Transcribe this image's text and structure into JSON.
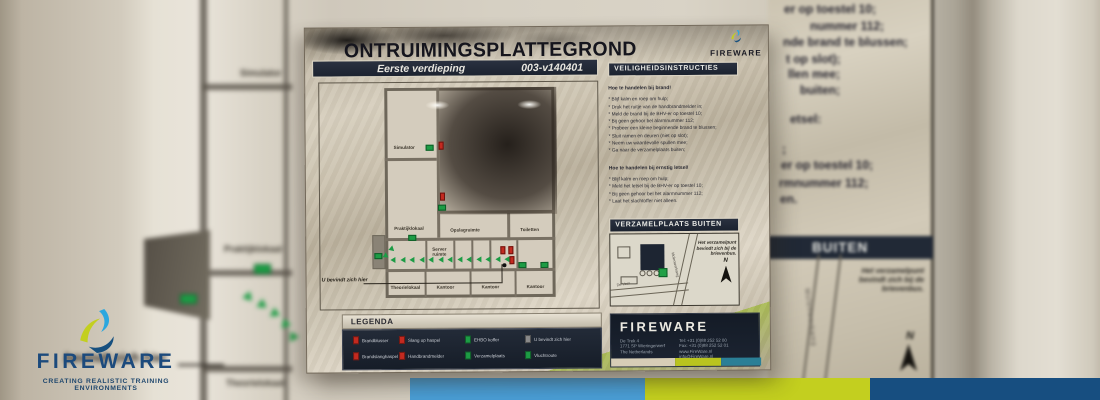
{
  "branding": {
    "wordmark": "FIREWARE",
    "tagline": "CREATING REALISTIC TRAINING ENVIRONMENTS",
    "colors": {
      "cyan": "#2ba7df",
      "lime": "#c3cf1f",
      "navy": "#17507f"
    }
  },
  "bottom_bars": {
    "blue": "#4a9ed6",
    "lime": "#c3cf1f",
    "navy": "#174e80"
  },
  "sign": {
    "title": "ONTRUIMINGSPLATTEGROND",
    "floor_label": "Eerste verdieping",
    "doc_number": "003-v140401",
    "brand": "FIREWARE",
    "you_are_here_label": "U bevindt zich hier",
    "floorplan": {
      "rooms": {
        "simulator": "Simulator",
        "praktijklokaal": "Praktijklokaal",
        "opslagruimte": "Opslagruimte",
        "toiletten": "Toiletten",
        "serverruimte": "Server ruimte",
        "theorielokaal": "Theorielokaal",
        "kantoor1": "Kantoor",
        "kantoor2": "Kantoor",
        "kantoor3": "Kantoor"
      }
    },
    "instructions": {
      "header": "VEILIGHEIDSINSTRUCTIES",
      "fire_title": "Hoe te handelen bij brand!",
      "fire_items": [
        "* Blijf kalm en roep om hulp;",
        "* Druk het ruitje van de handbrandmelder in;",
        "* Meld de brand bij de BHV-er op toestel 10;",
        "* Bij geen gehoor bel alarmnummer 112;",
        "* Probeer een kleine beginnende brand te blussen;",
        "* Sluit ramen en deuren (niet op slot);",
        "* Neem uw waardevolle spullen mee;",
        "* Ga naar de verzamelplaats buiten;"
      ],
      "injury_title": "Hoe te handelen bij ernstig letsel!",
      "injury_items": [
        "* Blijf kalm en roep om hulp;",
        "* Meld het letsel bij de BHV-er op toestel 10;",
        "* Bij geen gehoor bel het alarmnummer 112;",
        "* Laat het slachtoffer niet alleen."
      ]
    },
    "assembly": {
      "header": "VERZAMELPLAATS BUITEN",
      "note": "Het verzamelpunt bevindt zich bij de brievenbus.",
      "north": "N",
      "street_diagonal": "Molenwerkweg",
      "street_bottom": "De Vest"
    },
    "legend": {
      "header": "LEGENDA",
      "items": [
        {
          "label": "Brandblusser",
          "color": "#c32a20"
        },
        {
          "label": "Slang op haspel",
          "color": "#c32a20"
        },
        {
          "label": "EHBO koffer",
          "color": "#1d9c45"
        },
        {
          "label": "U bevindt zich hier",
          "color": "#8a8a8a"
        },
        {
          "label": "Brandslanghaspel",
          "color": "#c32a20"
        },
        {
          "label": "Handbrandmelder",
          "color": "#c32a20"
        },
        {
          "label": "Verzamelplaats",
          "color": "#1d9c45"
        },
        {
          "label": "Vluchtroute",
          "color": "#1d9c45"
        }
      ]
    },
    "footer": {
      "brand": "FIREWARE",
      "address": [
        "De Trek 4",
        "1771 SP Wieringerwerf",
        "The Netherlands"
      ],
      "contact": [
        "Tel: +31 (0)88 252 52 00",
        "Fax: +31 (0)88 252 52 01",
        "www.FireWare.nl",
        "info@FireWare.nl"
      ]
    }
  },
  "background": {
    "left": {
      "room_simulator": "Simulator",
      "room_praktijklokaal": "Praktijklokaal",
      "room_theorielokaal": "Theorielokaal",
      "you_are_here_fragment": "bevindt zich hier"
    },
    "right": {
      "text_fragments": [
        "er op toestel 10;",
        "nummer 112;",
        "nde brand te blussen;",
        "t op slot);",
        "llen mee;",
        "buiten;",
        "etsel:",
        ";",
        "er op toestel 10;",
        "rmnummer 112;",
        "en."
      ],
      "header_fragment": "BUITEN",
      "note": "Het verzamelpunt bevindt zich bij de brievenbus.",
      "street": "Molenwerkweg",
      "north": "N"
    }
  }
}
